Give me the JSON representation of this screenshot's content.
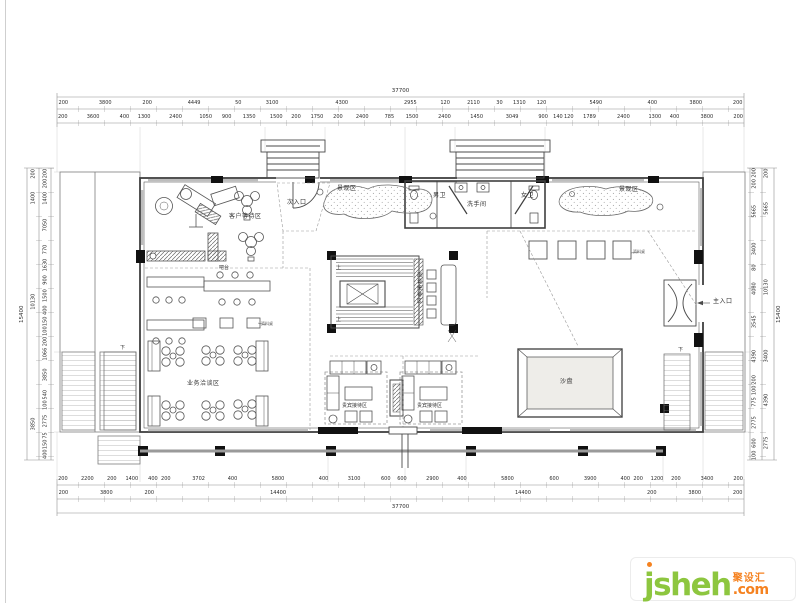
{
  "labels": {
    "landscape_left": "景观区",
    "landscape_right": "景观区",
    "mens_wc": "男卫",
    "washroom": "洗手间",
    "womens_wc": "女卫",
    "secondary_entrance": "次入口",
    "customer_waiting": "客户等待区",
    "bar": "吧台",
    "meeting_reception": "面谈接待区",
    "business_negotiation": "业务洽谈区",
    "vip_left": "贵宾接待区",
    "vip_right": "贵宾接待区",
    "sand_table": "沙盘",
    "main_entrance": "主入口",
    "materials_left": "资料桌",
    "materials_right": "资料桌",
    "down_left": "下",
    "down_right": "下",
    "up_top": "上",
    "up_bottom": "上"
  },
  "dimensions": {
    "top": {
      "total": "37700",
      "row1": [
        "200",
        "3800",
        "200",
        "4449",
        "50",
        "3100",
        "4300",
        "2955",
        "120",
        "2110",
        "30",
        "1310",
        "120",
        "5490",
        "400",
        "3800",
        "200"
      ],
      "row2": [
        "200",
        "3600",
        "400",
        "1300",
        "2400",
        "1050",
        "900",
        "1350",
        "1500",
        "200",
        "1750",
        "200",
        "2400",
        "785",
        "1500",
        "2400",
        "1450",
        "3049",
        "900",
        "140",
        "120",
        "1789",
        "2400",
        "1300",
        "400",
        "3800",
        "200"
      ]
    },
    "bottom": {
      "total": "37700",
      "row1": [
        "200",
        "2200",
        "200",
        "1400",
        "400",
        "200",
        "3702",
        "400",
        "5800",
        "400",
        "3100",
        "600",
        "600",
        "2900",
        "400",
        "5800",
        "600",
        "3900",
        "400",
        "200",
        "1200",
        "200",
        "3400",
        "200"
      ],
      "row2": [
        "200",
        "3800",
        "200",
        "14400",
        "14400",
        "200",
        "3800",
        "200"
      ]
    },
    "left": {
      "outer": "15400",
      "mid": [
        "200",
        "1400",
        "10130",
        "3850"
      ],
      "inner": [
        "200",
        "200",
        "1400",
        "7050",
        "770",
        "1630",
        "900",
        "1500",
        "400",
        "150",
        "100",
        "200",
        "1066",
        "3850",
        "540",
        "100",
        "2775",
        "75",
        "150",
        "400"
      ]
    },
    "right": {
      "outer": "15400",
      "mid": [
        "200",
        "5665",
        "10130",
        "3400",
        "4390",
        "2775"
      ],
      "inner": [
        "200",
        "200",
        "5665",
        "3400",
        "80",
        "4080",
        "3545",
        "4390",
        "200",
        "100",
        "775",
        "2775",
        "600",
        "100"
      ]
    }
  },
  "logo": {
    "brand": "jsheh",
    "cn": "聚设汇",
    "tld": ".com",
    "brand_color": "#8dc63f",
    "accent_color": "#f58220"
  }
}
